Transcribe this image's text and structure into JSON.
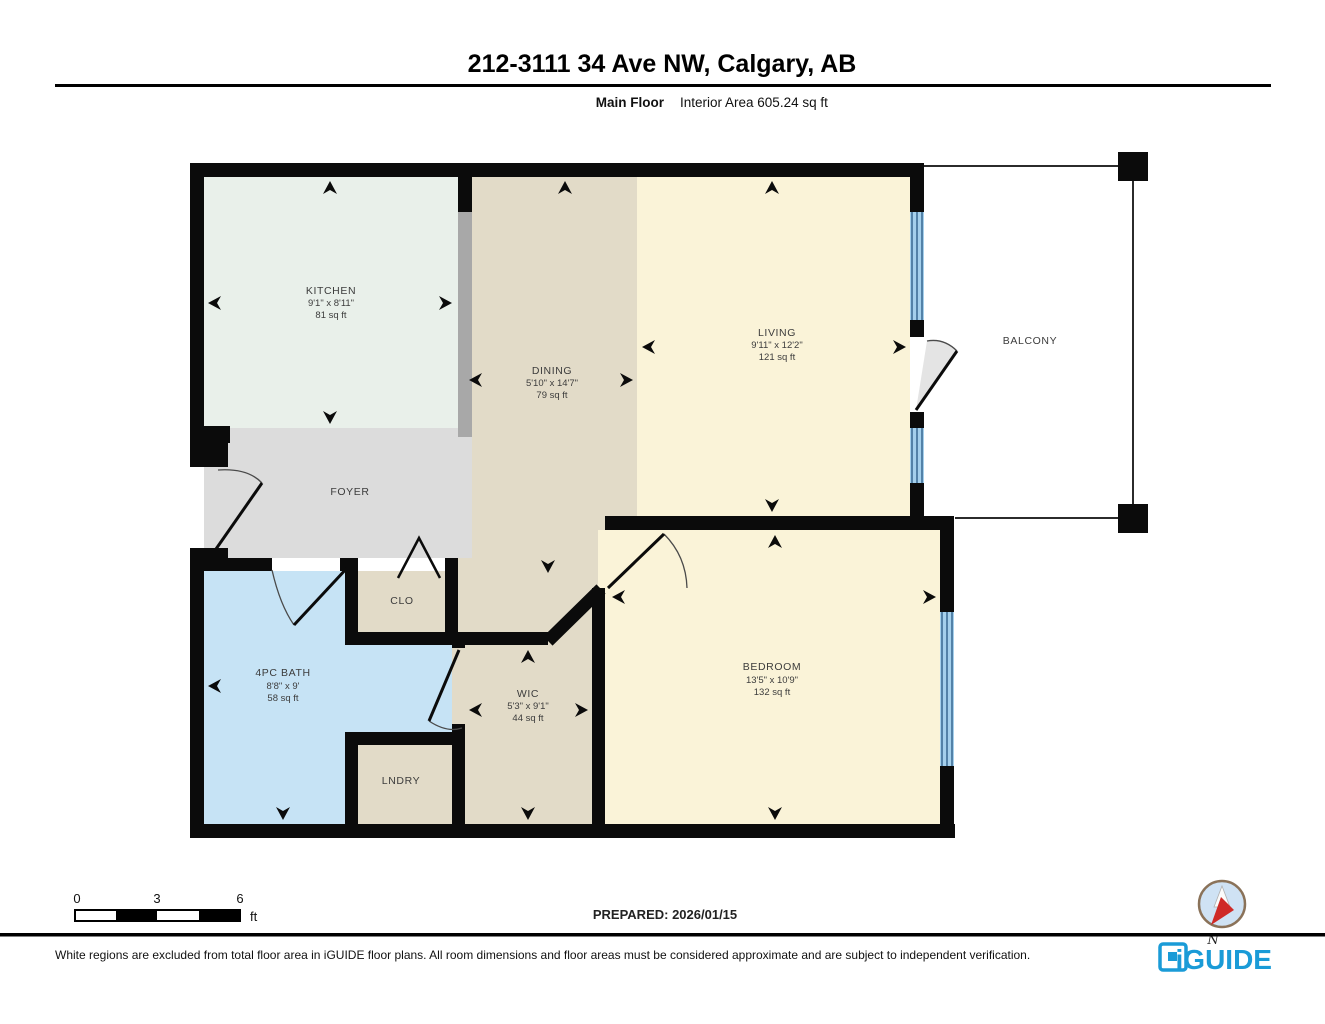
{
  "header": {
    "title": "212-3111 34 Ave NW, Calgary, AB",
    "floor_label": "Main Floor",
    "area_label": "Interior Area 605.24 sq ft"
  },
  "rooms": {
    "kitchen": {
      "name": "KITCHEN",
      "dims": "9'1\" x 8'11\"",
      "area": "81 sq ft"
    },
    "dining": {
      "name": "DINING",
      "dims": "5'10\" x 14'7\"",
      "area": "79 sq ft"
    },
    "living": {
      "name": "LIVING",
      "dims": "9'11\" x 12'2\"",
      "area": "121 sq ft"
    },
    "bedroom": {
      "name": "BEDROOM",
      "dims": "13'5\" x 10'9\"",
      "area": "132 sq ft"
    },
    "bath": {
      "name": "4PC BATH",
      "dims": "8'8\" x 9'",
      "area": "58 sq ft"
    },
    "wic": {
      "name": "WIC",
      "dims": "5'3\" x 9'1\"",
      "area": "44 sq ft"
    },
    "foyer": {
      "name": "FOYER"
    },
    "clo": {
      "name": "CLO"
    },
    "lndry": {
      "name": "LNDRY"
    },
    "balcony": {
      "name": "BALCONY"
    }
  },
  "scale_bar": {
    "tick0": "0",
    "tick3": "3",
    "tick6": "6",
    "unit": "ft"
  },
  "footer": {
    "prepared": "PREPARED: 2026/01/15",
    "disclaimer": "White regions are excluded from total floor area in iGUIDE floor plans. All room dimensions and floor areas must be considered approximate and are subject to independent verification.",
    "brand": "iGUIDE",
    "compass_label": "N"
  },
  "colors": {
    "wall": "#0b0b0b",
    "kitchen": "#e9f0ea",
    "tan": "#e2dbc8",
    "yellow": "#faf3d8",
    "foyer": "#dcdcdc",
    "bath": "#c6e3f5",
    "counter": "#a8a8a8",
    "window": "#a5d0ec",
    "windowline": "#31618c",
    "brand": "#1a9bd7"
  }
}
